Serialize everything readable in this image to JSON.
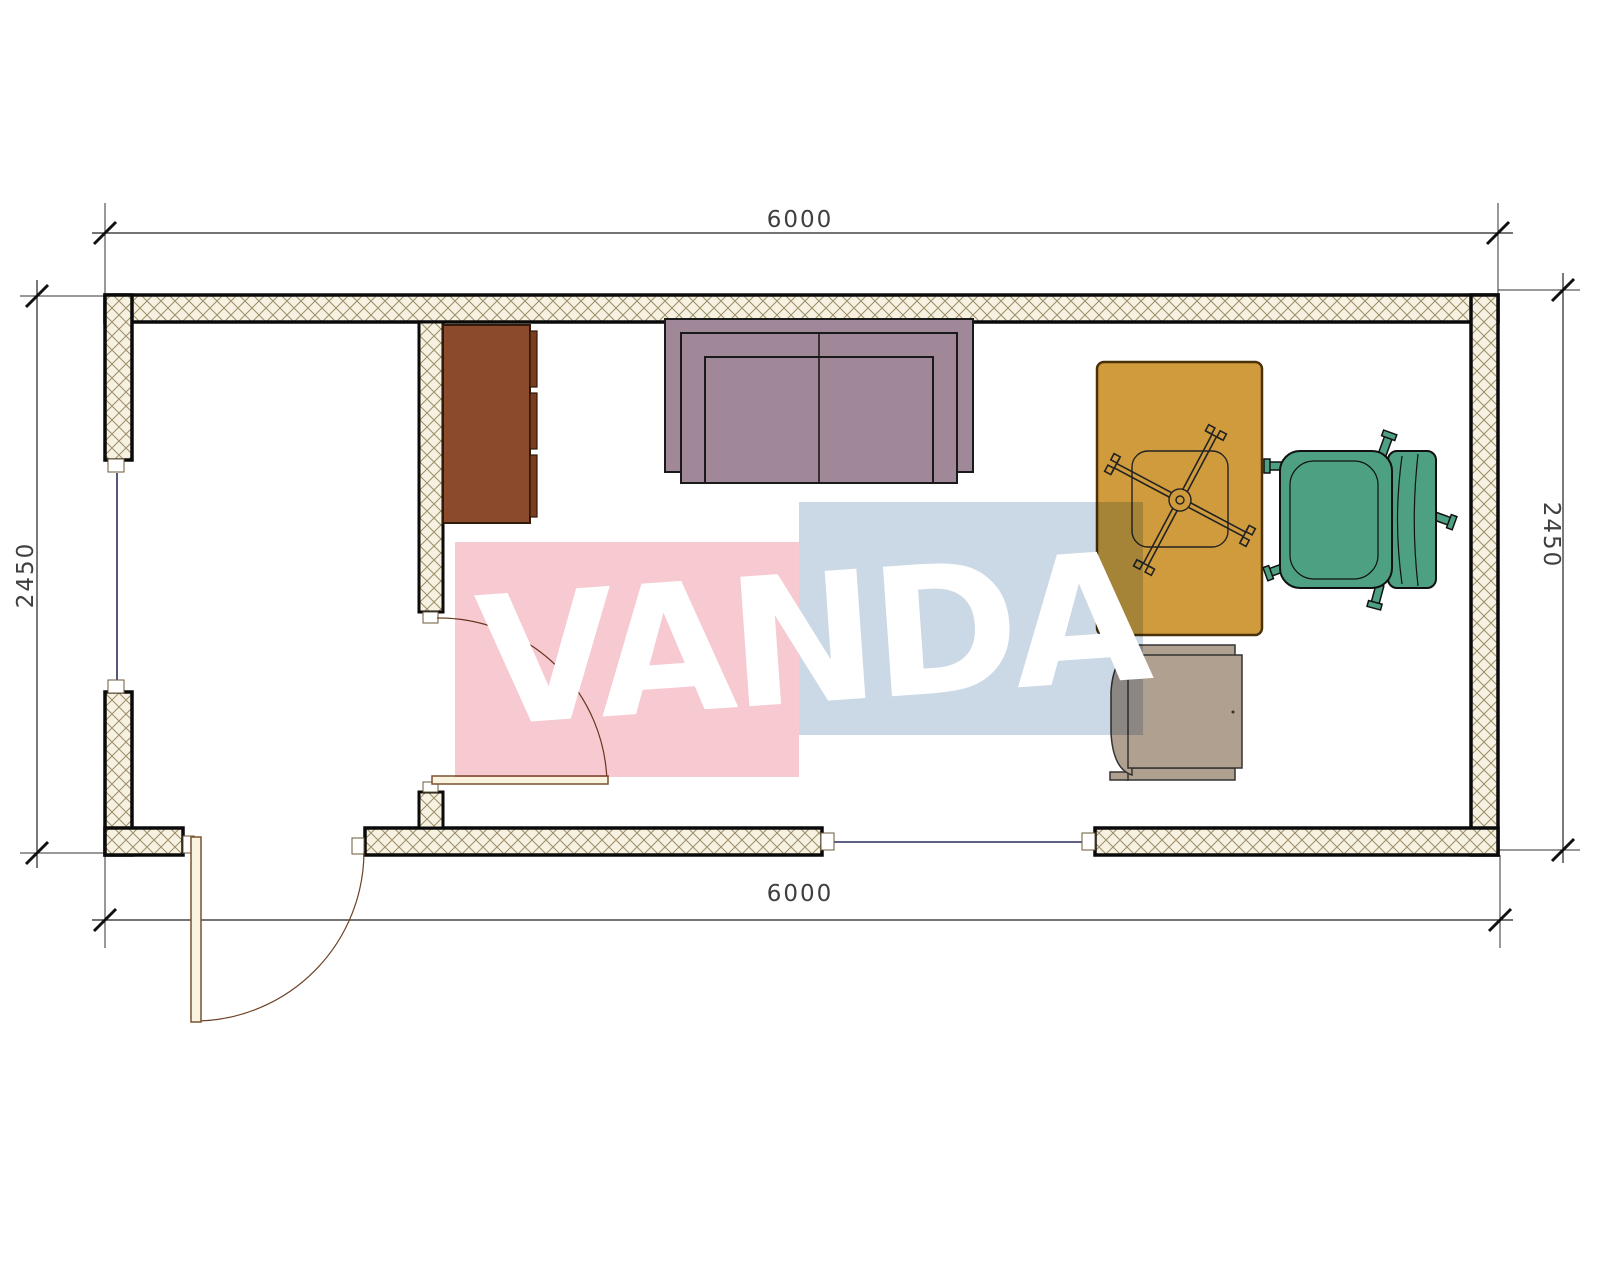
{
  "drawing": {
    "title": "floor-plan",
    "dimensions": {
      "top": "6000",
      "bottom": "6000",
      "left": "2450",
      "right": "2450"
    },
    "watermark": {
      "text": "VANDA"
    },
    "furniture_labels": {
      "cabinet": "cabinet",
      "sofa": "sofa",
      "desk": "desk",
      "office_chair": "office-chair",
      "armchair": "armchair",
      "side_chair": "side-chair"
    }
  },
  "colors": {
    "wall_hatch_bg": "#f6f1e1",
    "wall_hatch_line": "#9b8e66",
    "wall_edge": "#0a0a0a",
    "cabinet": "#8a4a2b",
    "cabinet_front": "#7a3d20",
    "sofa": "#a18898",
    "desk": "#cf9b3d",
    "desk_edge": "#4a3208",
    "chair_green": "#4da081",
    "chair_tan": "#b0a090",
    "door": "#faf3df",
    "door_frame": "#7a5230",
    "window_line": "#2b2b5e",
    "dimension": "#3f3f3f",
    "watermark_pink": "#f7c9d0",
    "watermark_blue": "#cbd8e6",
    "watermark_text": "#ffffff"
  }
}
